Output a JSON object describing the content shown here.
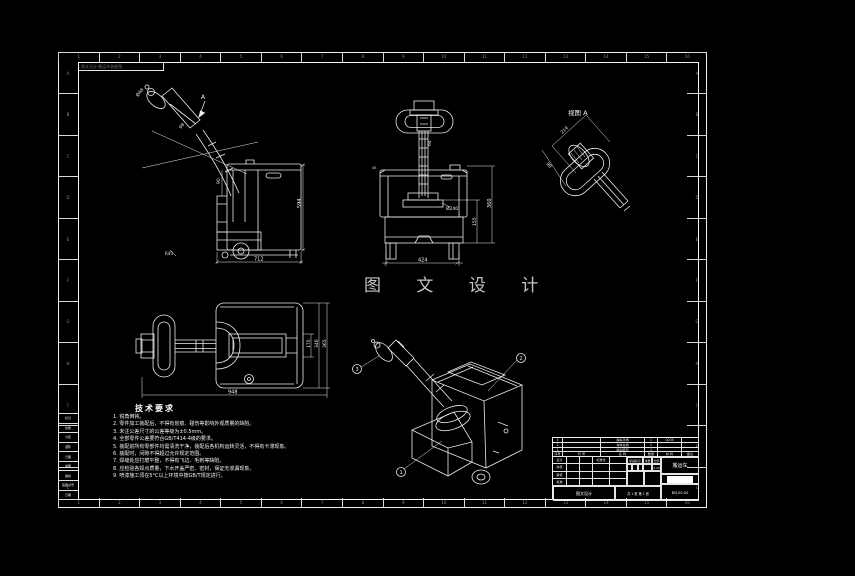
{
  "watermark": {
    "text": "图 文 设 计"
  },
  "corner_box": {
    "text": "图文设计·搬运车装配图"
  },
  "frame": {
    "top_labels": [
      "1",
      "2",
      "3",
      "4",
      "5",
      "6",
      "7",
      "8",
      "9",
      "10",
      "11",
      "12",
      "13",
      "14",
      "15",
      "16"
    ],
    "bottom_labels": [
      "1",
      "2",
      "3",
      "4",
      "5",
      "6",
      "7",
      "8",
      "9",
      "10",
      "11",
      "12",
      "13",
      "14",
      "15",
      "16"
    ],
    "left_labels": [
      "A",
      "B",
      "C",
      "D",
      "E",
      "F",
      "G",
      "H",
      "J",
      "K",
      "L"
    ],
    "right_labels": [
      "A",
      "B",
      "C",
      "D",
      "E",
      "F",
      "G",
      "H",
      "J",
      "K",
      "L"
    ]
  },
  "views": {
    "side_view": {
      "dim_d48": "Ø48",
      "dim_98": "98",
      "dim_90": "90",
      "dim_594": "594",
      "dim_712": "712",
      "dim_r45": "R45",
      "section_label": "A"
    },
    "front_view": {
      "dim_64": "64",
      "dim_d240": "Ø240",
      "dim_360": "360",
      "dim_155": "155",
      "dim_424": "424",
      "dim_45": "45"
    },
    "plan_view": {
      "dim_170": "170",
      "dim_346": "346",
      "dim_365": "365",
      "dim_948": "948"
    },
    "detail_view": {
      "label": "视图 A",
      "dim_214": "214",
      "dim_98": "98"
    },
    "iso_view": {
      "balloon_1": "1",
      "balloon_2": "2",
      "balloon_3": "3"
    }
  },
  "notes": {
    "title": "技术要求",
    "lines": [
      "1. 锐角倒钝。",
      "2. 零件加工装配后，不得有划痕、碰伤等影响外观质量的缺陷。",
      "3. 未注公差尺寸的公差等级为±0.5mm。",
      "4. 全部零件公差要符合GB/T414-4级的要求。",
      "5. 装配前所有零部件均需清洗干净，装配后各机构运转灵活，不得有卡滞现象。",
      "6. 装配时，间隙不得超过允许规定范围。",
      "7. 焊缝处应打磨平整，不得有飞边、毛刺等缺陷。",
      "8. 应检验各焊点质量，下水开盖严密、密封，保证无渗漏现象。",
      "9. 喷漆施工须在5°C以上环境中按GB/T规定进行。"
    ]
  },
  "parts_list": {
    "header": [
      "序号",
      "代  号",
      "名  称",
      "数量",
      "材 料",
      "备注"
    ],
    "rows": [
      [
        "3",
        "",
        "操纵手柄",
        "1",
        "Q235",
        ""
      ],
      [
        "2",
        "",
        "车体总成",
        "1",
        "",
        ""
      ],
      [
        "1",
        "",
        "驱动装置",
        "1",
        "",
        ""
      ]
    ]
  },
  "title_block": {
    "sign_labels": [
      "设计",
      "校核",
      "审核",
      "批准"
    ],
    "standard_label": "标准化",
    "stage_label": "阶段标记",
    "weight_label": "重量",
    "scale_label": "比例",
    "scale_value": "1:10",
    "company": "图文设计",
    "sheet_info": "共 1 张  第 1 张",
    "title": "搬运车",
    "code": "BYJ-00-00"
  },
  "margin_table": {
    "rows": [
      "标记",
      "处数",
      "分区",
      "签字",
      "日期",
      "描图",
      "描校",
      "底图总号",
      "日期"
    ]
  }
}
